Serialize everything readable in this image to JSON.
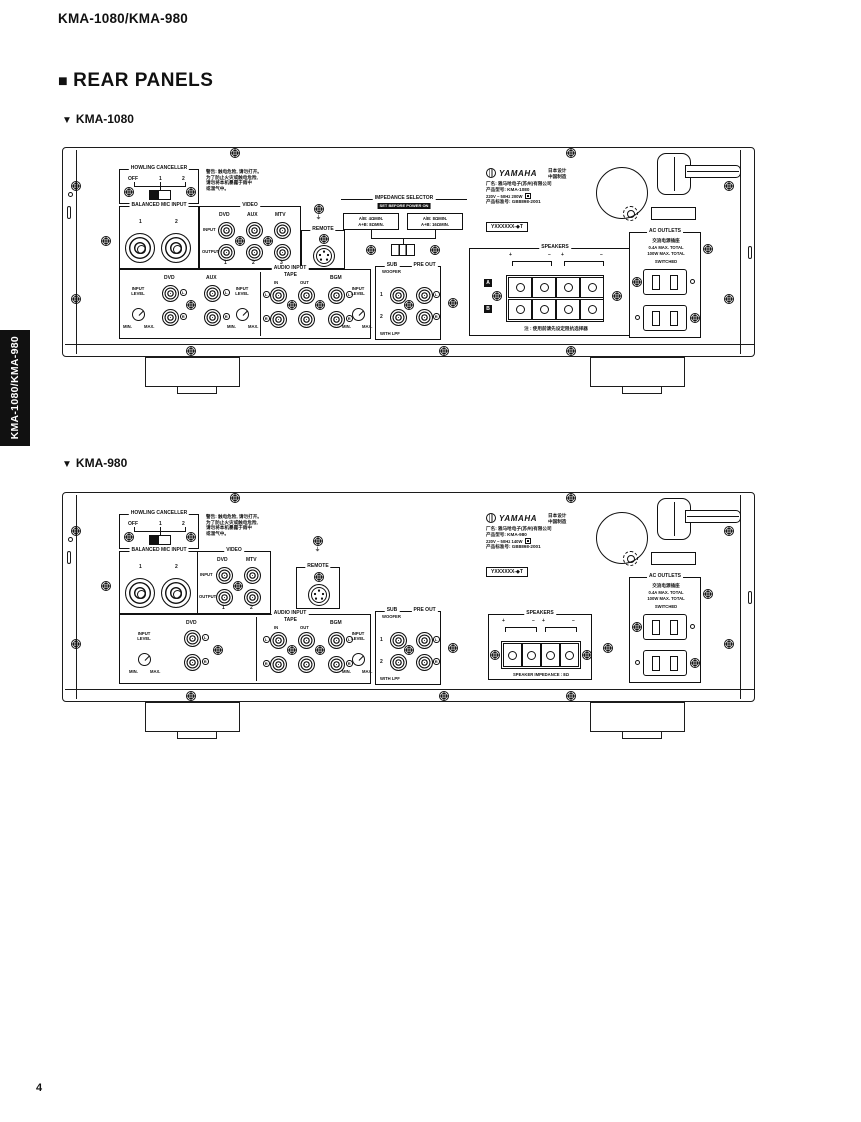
{
  "page": {
    "header": "KMA-1080/KMA-980",
    "section_marker": "■",
    "section_title": "REAR PANELS",
    "label_marker": "▼",
    "sidebar_tab": "KMA-1080/KMA-980",
    "page_number": "4"
  },
  "common": {
    "howling_canceller": "HOWLING CANCELLER",
    "off": "OFF",
    "n1": "1",
    "n2": "2",
    "n3": "3",
    "balanced_mic_input": "BALANCED MIC INPUT",
    "video": "VIDEO",
    "input": "INPUT",
    "output": "OUTPUT",
    "dvd": "DVD",
    "aux": "AUX",
    "mtv": "MTV",
    "remote": "REMOTE",
    "ground_symbol": "⏚",
    "warning_lines": [
      "警告: 触电危险, 请勿打开。",
      "为了防止火灾或触电危险,",
      "请勿将本机暴露于雨中",
      "或湿气中。"
    ],
    "audio_input": "AUDIO INPUT",
    "input_level_l1": "INPUT",
    "input_level_l2": "LEVEL",
    "min": "MIN.",
    "max": "MAX.",
    "tape": "TAPE",
    "tape_in": "IN",
    "tape_out": "OUT",
    "bgm": "BGM",
    "sub_l1": "SUB",
    "sub_l2": "WOOFER",
    "pre_out": "PRE OUT",
    "with_lpf": "WITH LPF",
    "l": "L",
    "r": "R",
    "a": "A",
    "b": "B",
    "plus": "+",
    "minus": "−",
    "speakers": "SPEAKERS",
    "ac_outlets": "AC OUTLETS",
    "ac_outlets_cjk": "交流电源插座",
    "ac_line1": "0.4A MAX. TOTAL",
    "ac_line2": "100W MAX. TOTAL",
    "switched": "SWITCHED",
    "brand": "YAMAHA",
    "made_line1": "日本设计",
    "made_line2": "中国制造",
    "company_line": "厂名: 雅马哈电子(苏州)有限公司",
    "std_line": "产品标准号: GB8898-2001",
    "serial_label": "YXXXXXX-◆T"
  },
  "k1080": {
    "name": "KMA-1080",
    "model_line": "产品型号: KMA-1080",
    "power_line": "220V ~ 50Hz 200W",
    "impedance_title": "IMPEDANCE SELECTOR",
    "impedance_note": "SET BEFORE POWER ON",
    "imp_left_l1": "A/B: 4ΩMIN.",
    "imp_left_l2": "A+B: 8ΩMIN.",
    "imp_right_l1": "A/B: 8ΩMIN.",
    "imp_right_l2": "A+B: 16ΩMIN.",
    "speakers_caption": "注 : 使用前请先设定阻抗选择器"
  },
  "k980": {
    "name": "KMA-980",
    "model_line": "产品型号: KMA-980",
    "power_line": "220V ~ 50Hz 140W",
    "speakers_caption": "SPEAKER IMPEDANCE : 8Ω"
  }
}
